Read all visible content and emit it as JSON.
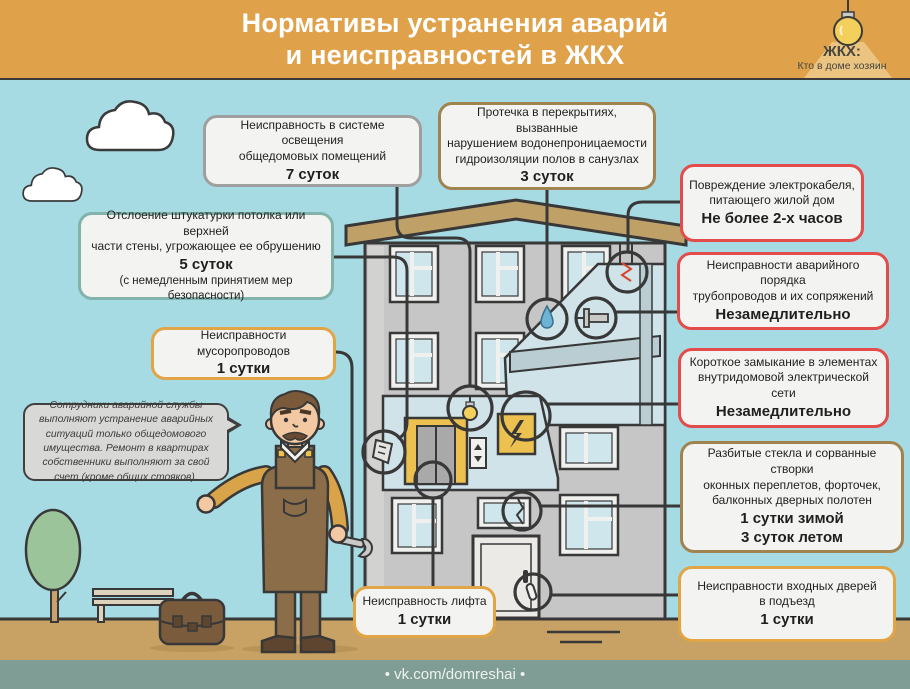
{
  "header": {
    "title_line1": "Нормативы устранения аварий",
    "title_line2": "и неисправностей в ЖКХ",
    "logo": {
      "icon": "lightbulb-icon",
      "line1": "ЖКХ:",
      "line2": "Кто в доме хозяин"
    }
  },
  "callouts": [
    {
      "id": "lighting",
      "lines": [
        "Неисправность в системе освещения",
        "общедомовых помещений"
      ],
      "value": "7 суток",
      "border": "#9f9f9f"
    },
    {
      "id": "leak-ceilings",
      "lines": [
        "Протечка в перекрытиях, вызванные",
        "нарушением водонепроницаемости",
        "гидроизоляции полов в санузлах"
      ],
      "value": "3 суток",
      "border": "#a1834f"
    },
    {
      "id": "plaster",
      "lines": [
        "Отслоение штукатурки потолка или верхней",
        "части стены, угрожающее ее обрушению"
      ],
      "value": "5 суток",
      "note": "(с немедленным принятием мер безопасности)",
      "border": "#82b3aa"
    },
    {
      "id": "trash-chute",
      "lines": [
        "Неисправности мусоропроводов"
      ],
      "value": "1 сутки",
      "border": "#e2a545"
    },
    {
      "id": "electric-cable",
      "lines": [
        "Повреждение электрокабеля,",
        "питающего жилой дом"
      ],
      "value": "Не более 2-х часов",
      "border": "#e44b4b"
    },
    {
      "id": "pipelines",
      "lines": [
        "Неисправности аварийного порядка",
        "трубопроводов и их сопряжений"
      ],
      "value": "Незамедлительно",
      "border": "#e44b4b"
    },
    {
      "id": "short-circuit",
      "lines": [
        "Короткое замыкание в элементах",
        "внутридомовой электрической сети"
      ],
      "value": "Незамедлительно",
      "border": "#e44b4b"
    },
    {
      "id": "broken-glass",
      "lines": [
        "Разбитые стекла и сорванные створки",
        "оконных переплетов, форточек,",
        "балконных дверных полотен"
      ],
      "value": "1 сутки зимой",
      "value2": "3 суток летом",
      "border": "#a1834f"
    },
    {
      "id": "entrance-doors",
      "lines": [
        "Неисправности входных дверей",
        "в подъезд"
      ],
      "value": "1 сутки",
      "border": "#e2a545"
    },
    {
      "id": "elevator",
      "lines": [
        "Неисправность лифта"
      ],
      "value": "1 сутки",
      "border": "#e2a545"
    }
  ],
  "note": {
    "text": "Сотрудники аварийной службы выполняют устранение аварийных ситуаций только общедомового имущества. Ремонт в квартирах собственники выполняют за свой счет (кроме общих стояков)."
  },
  "footer": {
    "text": "• vk.com/domreshai •"
  },
  "colors": {
    "header_bg": "#dfa24a",
    "sky": "#a6dbe4",
    "ground": "#c8a264",
    "footer_bg": "#7f9d95",
    "box_fill": "#f3f3f1",
    "accent_red": "#e44b4b",
    "accent_orange": "#e2a545",
    "accent_tan": "#a1834f",
    "accent_teal": "#82b3aa",
    "accent_gray": "#9f9f9f",
    "outline": "#383838"
  }
}
